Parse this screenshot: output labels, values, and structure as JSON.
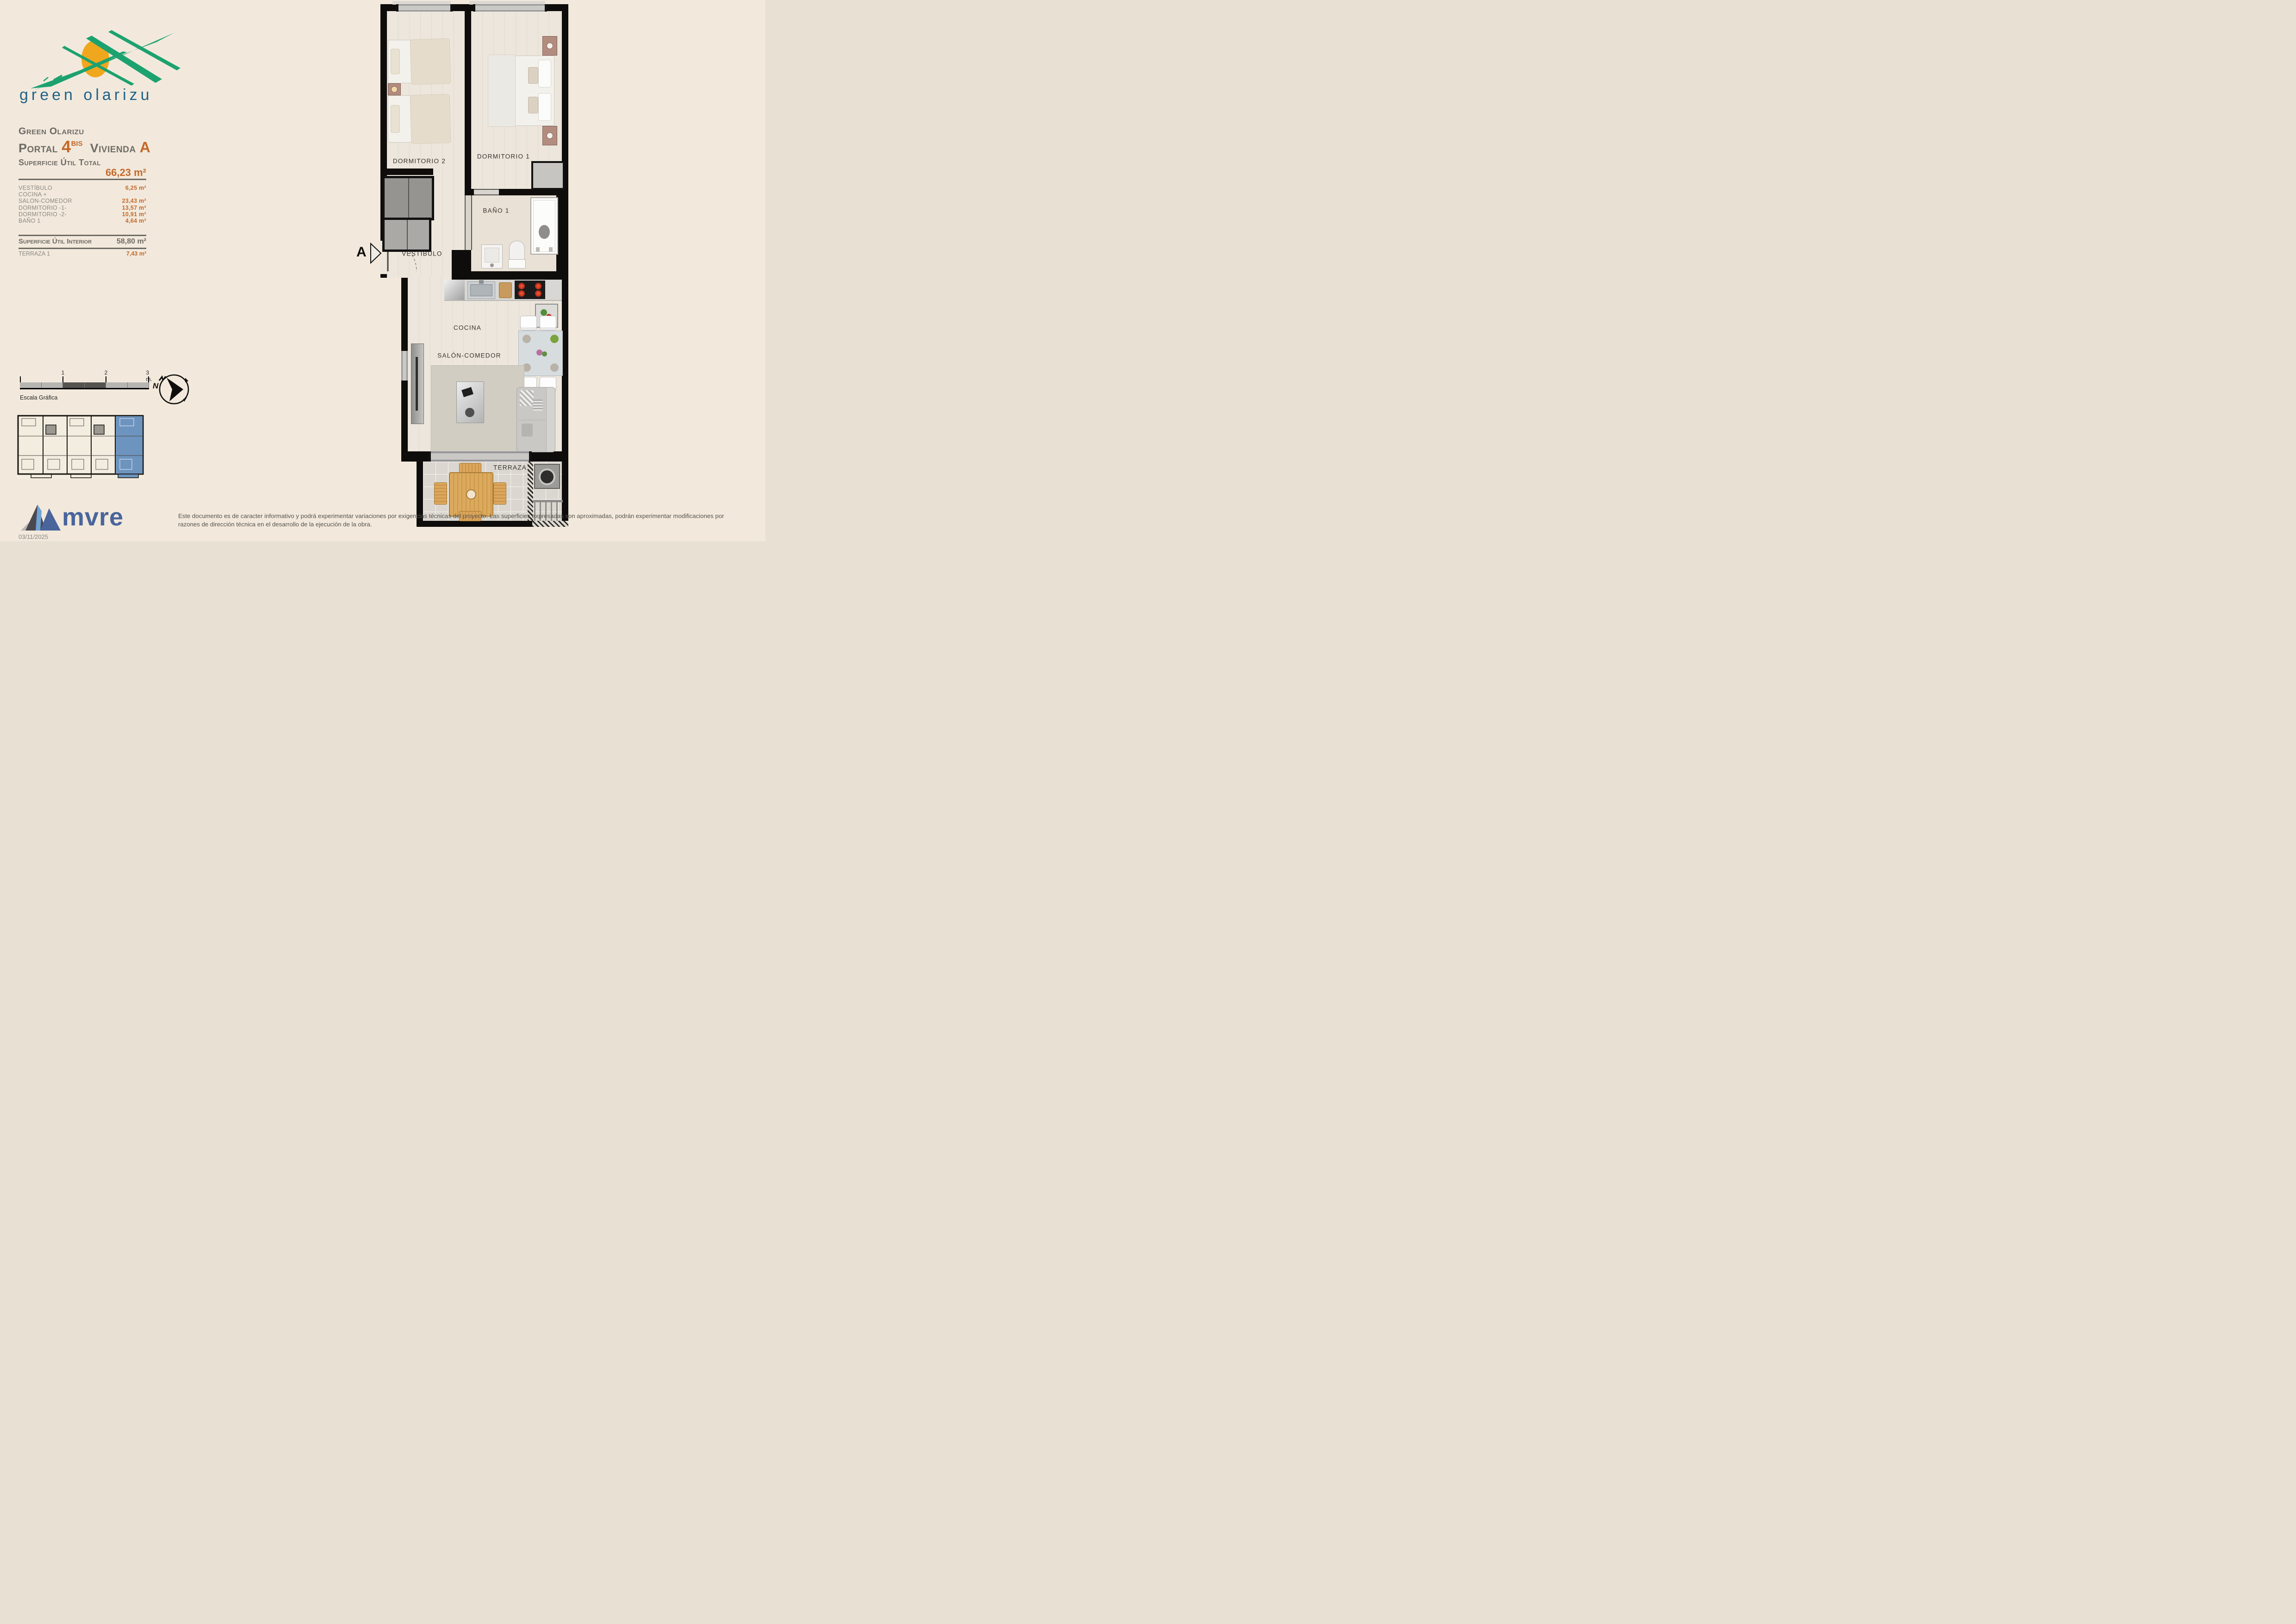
{
  "brand": {
    "logo_text": "green olarizu",
    "developer": "mvre"
  },
  "header": {
    "project": "Green Olarizu",
    "portal_label": "Portal",
    "portal_number": "4",
    "portal_suffix": "BIS",
    "unit_label": "Vivienda",
    "unit_letter": "A"
  },
  "areas": {
    "total_label": "Superficie Útil Total",
    "total_value": "66,23 m²",
    "rows": [
      {
        "label": "VESTÍBULO",
        "value": "6,25 m²"
      },
      {
        "label": "COCINA +",
        "value": ""
      },
      {
        "label": "SALON-COMEDOR",
        "value": "23,43 m²"
      },
      {
        "label": "DORMITORIO -1-",
        "value": "13,57 m²"
      },
      {
        "label": "DORMITORIO -2-",
        "value": "10,91 m²"
      },
      {
        "label": "BAÑO 1",
        "value": "4,64 m²"
      }
    ],
    "interior_label": "Superficie Útil Interior",
    "interior_value": "58,80 m²",
    "terraza_label": "TERRAZA 1",
    "terraza_value": "7,43 m²"
  },
  "scale_bar": {
    "caption": "Escala Gráfica",
    "ticks": [
      "1",
      "2",
      "3 m."
    ]
  },
  "compass": {
    "north_label": "N"
  },
  "plan": {
    "section_marker": "A",
    "rooms": [
      {
        "name": "DORMITORIO 2"
      },
      {
        "name": "DORMITORIO 1"
      },
      {
        "name": "VESTÍBULO"
      },
      {
        "name": "BAÑO 1"
      },
      {
        "name": "COCINA"
      },
      {
        "name": "SALÓN-COMEDOR"
      },
      {
        "name": "TERRAZA"
      }
    ]
  },
  "footer": {
    "disclaimer_line1": "Este documento es de caracter informativo y podrá experimentar variaciones por exigencias técnicas del proyecto. Las superficies expresadas son aproximadas, podrán experimentar modificaciones por",
    "disclaimer_line2": "razones de dirección técnica en el desarrollo de la ejecución de la obra.",
    "date": "03/11/2025"
  },
  "colors": {
    "accent_orange": "#c4692a",
    "brand_teal": "#1f6288",
    "brand_green": "#1ca26f",
    "sun_orange": "#f0a71e",
    "mvre_blue": "#49659c",
    "highlight_blue": "#6d94bf"
  }
}
